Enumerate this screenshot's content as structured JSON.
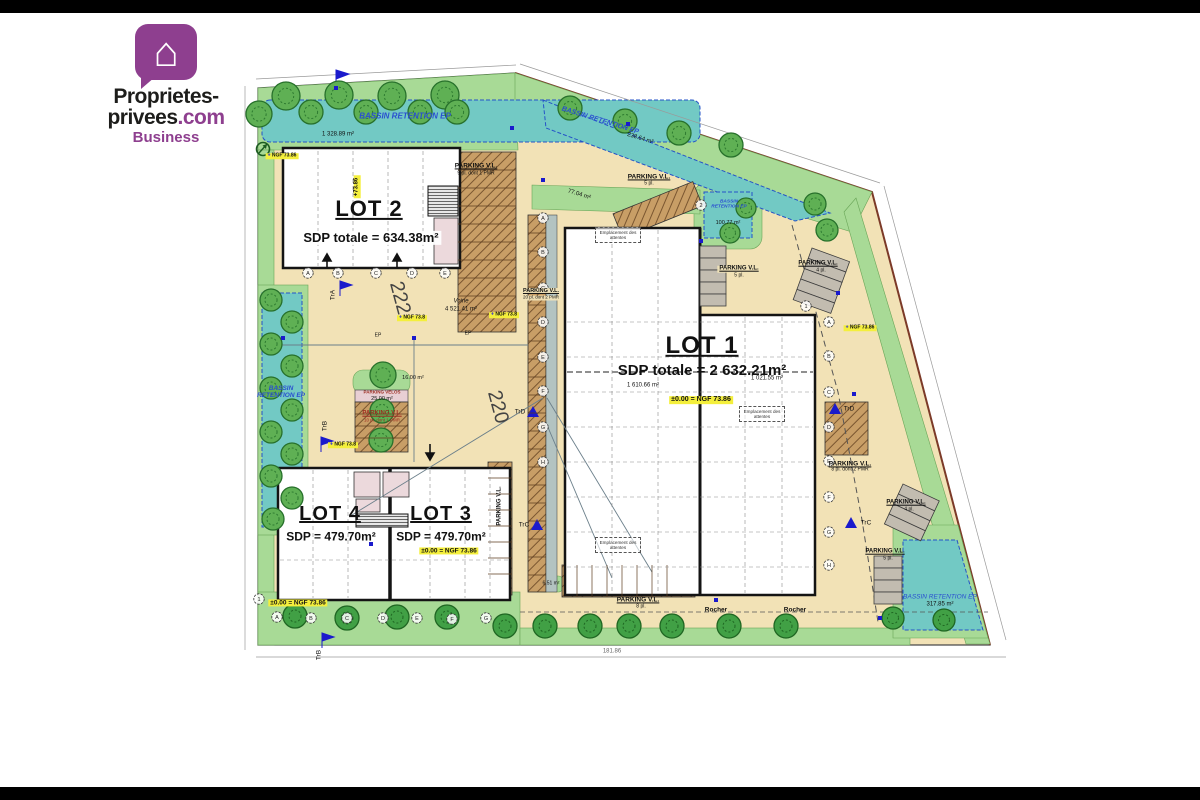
{
  "logo": {
    "line1": "Proprietes-",
    "line2a": "privees",
    "line2b": ".com",
    "line3": "Business"
  },
  "plan": {
    "lots": {
      "lot1": {
        "title": "LOT 1",
        "sdp": "SDP totale = 2 632.21m²",
        "zone_a": "1 610.66 m²",
        "zone_b": "1 021.55 m²",
        "ngf": "±0.00 = NGF 73.86"
      },
      "lot2": {
        "title": "LOT 2",
        "sdp": "SDP totale = 634.38m²",
        "level": "+73.86"
      },
      "lot3": {
        "title": "LOT 3",
        "sdp": "SDP = 479.70m²",
        "ngf": "±0.00 = NGF 73.86"
      },
      "lot4": {
        "title": "LOT 4",
        "sdp": "SDP = 479.70m²",
        "ngf": "±0.00 = NGF 73.86"
      }
    },
    "basins": {
      "north": {
        "label": "BASSIN RETENTION EP",
        "area": "1 328.89 m²"
      },
      "north_east": {
        "label": "BASSIN RETENTION EP",
        "area": "238.64 m²"
      },
      "east": {
        "label": "BASSIN RETENTION EP",
        "area": "100.77 m²"
      },
      "west": {
        "label": "BASSIN RETENTION EP"
      },
      "south_east": {
        "label": "BASSIN RETENTION EP",
        "area": "317.85 m²"
      }
    },
    "parking": {
      "label": "PARKING V.L.",
      "lot2_east": "9 pl. dont 1 PMR",
      "north": "5 pl.",
      "east_col": "5 pl.",
      "north_east": "4 pl.",
      "west_strip": "20 pl. dont 2 PMR",
      "middle": "10 pl. dont 1 PMR",
      "east": "8 pl. dont 2 PMR",
      "east_diag": "4 pl.",
      "south_east": "5 pl.",
      "south": "8 pl.",
      "velos": "PARKING VELOS",
      "velos_area": "25.00 m²"
    },
    "road": {
      "num_a": "222",
      "num_b": "220",
      "voirie": "Voirie",
      "voirie_area": "4 521.41 m²"
    },
    "areas": {
      "a77": "77.04 m²",
      "a16": "16.00 m²",
      "a651": "6.51 m²"
    },
    "markers": {
      "tra": "TrA",
      "trb": "TrB",
      "trc": "TrC",
      "trd": "TrD",
      "ngf": "NGF 73.86",
      "ngf_small": "NGF 73.8",
      "ep": "EP",
      "rocher": "Rocher",
      "dim": "181.86"
    },
    "notes": {
      "emplacement": "Emplacement des attentes"
    },
    "grid_letters": [
      "A",
      "B",
      "C",
      "D",
      "E",
      "F",
      "G",
      "H"
    ],
    "grid_numbers": [
      "1",
      "2"
    ]
  }
}
